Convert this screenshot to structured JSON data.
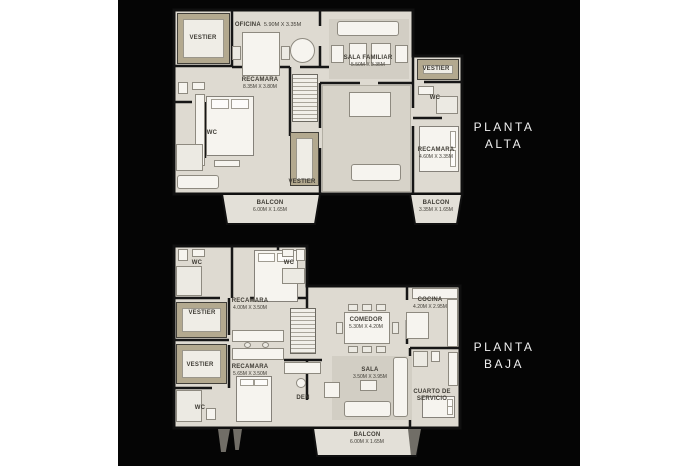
{
  "titles": {
    "alta": {
      "line1": "PLANTA",
      "line2": "ALTA"
    },
    "baja": {
      "line1": "PLANTA",
      "line2": "BAJA"
    }
  },
  "planta_alta": {
    "vestier_top_left": {
      "name": "VESTIER"
    },
    "oficina": {
      "name": "OFICINA",
      "dims": "5.90M X 3.35M"
    },
    "sala_familiar": {
      "name": "SALA FAMILIAR",
      "dims": "5.50M X 3.35M"
    },
    "vestier_right": {
      "name": "VESTIER"
    },
    "wc_right": {
      "name": "WC"
    },
    "recamara_principal": {
      "name": "RECAMARA",
      "dims": "8.35M X 3.80M"
    },
    "wc_left": {
      "name": "WC"
    },
    "vestier_bottom": {
      "name": "VESTIER"
    },
    "recamara_2": {
      "name": "RECAMARA",
      "dims": "4.60M X 3.35M"
    },
    "balcon_left": {
      "name": "BALCON",
      "dims": "6.00M X 1.65M"
    },
    "balcon_right": {
      "name": "BALCON",
      "dims": "3.35M X 1.65M"
    }
  },
  "planta_baja": {
    "wc_top_left": {
      "name": "WC"
    },
    "recamara_1": {
      "name": "RECAMARA",
      "dims": "4.00M X 3.50M"
    },
    "wc_top_mid": {
      "name": "WC"
    },
    "vestier_1": {
      "name": "VESTIER"
    },
    "vestier_2": {
      "name": "VESTIER"
    },
    "recamara_2": {
      "name": "RECAMARA",
      "dims": "5.65M X 3.50M"
    },
    "wc_bottom_left": {
      "name": "WC"
    },
    "comedor": {
      "name": "COMEDOR",
      "dims": "5.30M X 4.20M"
    },
    "cocina": {
      "name": "COCINA",
      "dims": "4.20M X 2.95M"
    },
    "sala": {
      "name": "SALA",
      "dims": "3.50M X 3.95M"
    },
    "den": {
      "name": "DEN"
    },
    "cuarto_servicio": {
      "line1": "CUARTO DE",
      "line2": "SERVICIO"
    },
    "balcon": {
      "name": "BALCON",
      "dims": "6.00M X 1.65M"
    }
  },
  "colors": {
    "backdrop": "#050505",
    "floor": "#dedad1",
    "balcony_floor": "#e3e0d8",
    "closet_tan": "#b3a98f",
    "wall": "#161616",
    "label_text": "#3f3c35",
    "title_text": "#f0f0f0"
  }
}
